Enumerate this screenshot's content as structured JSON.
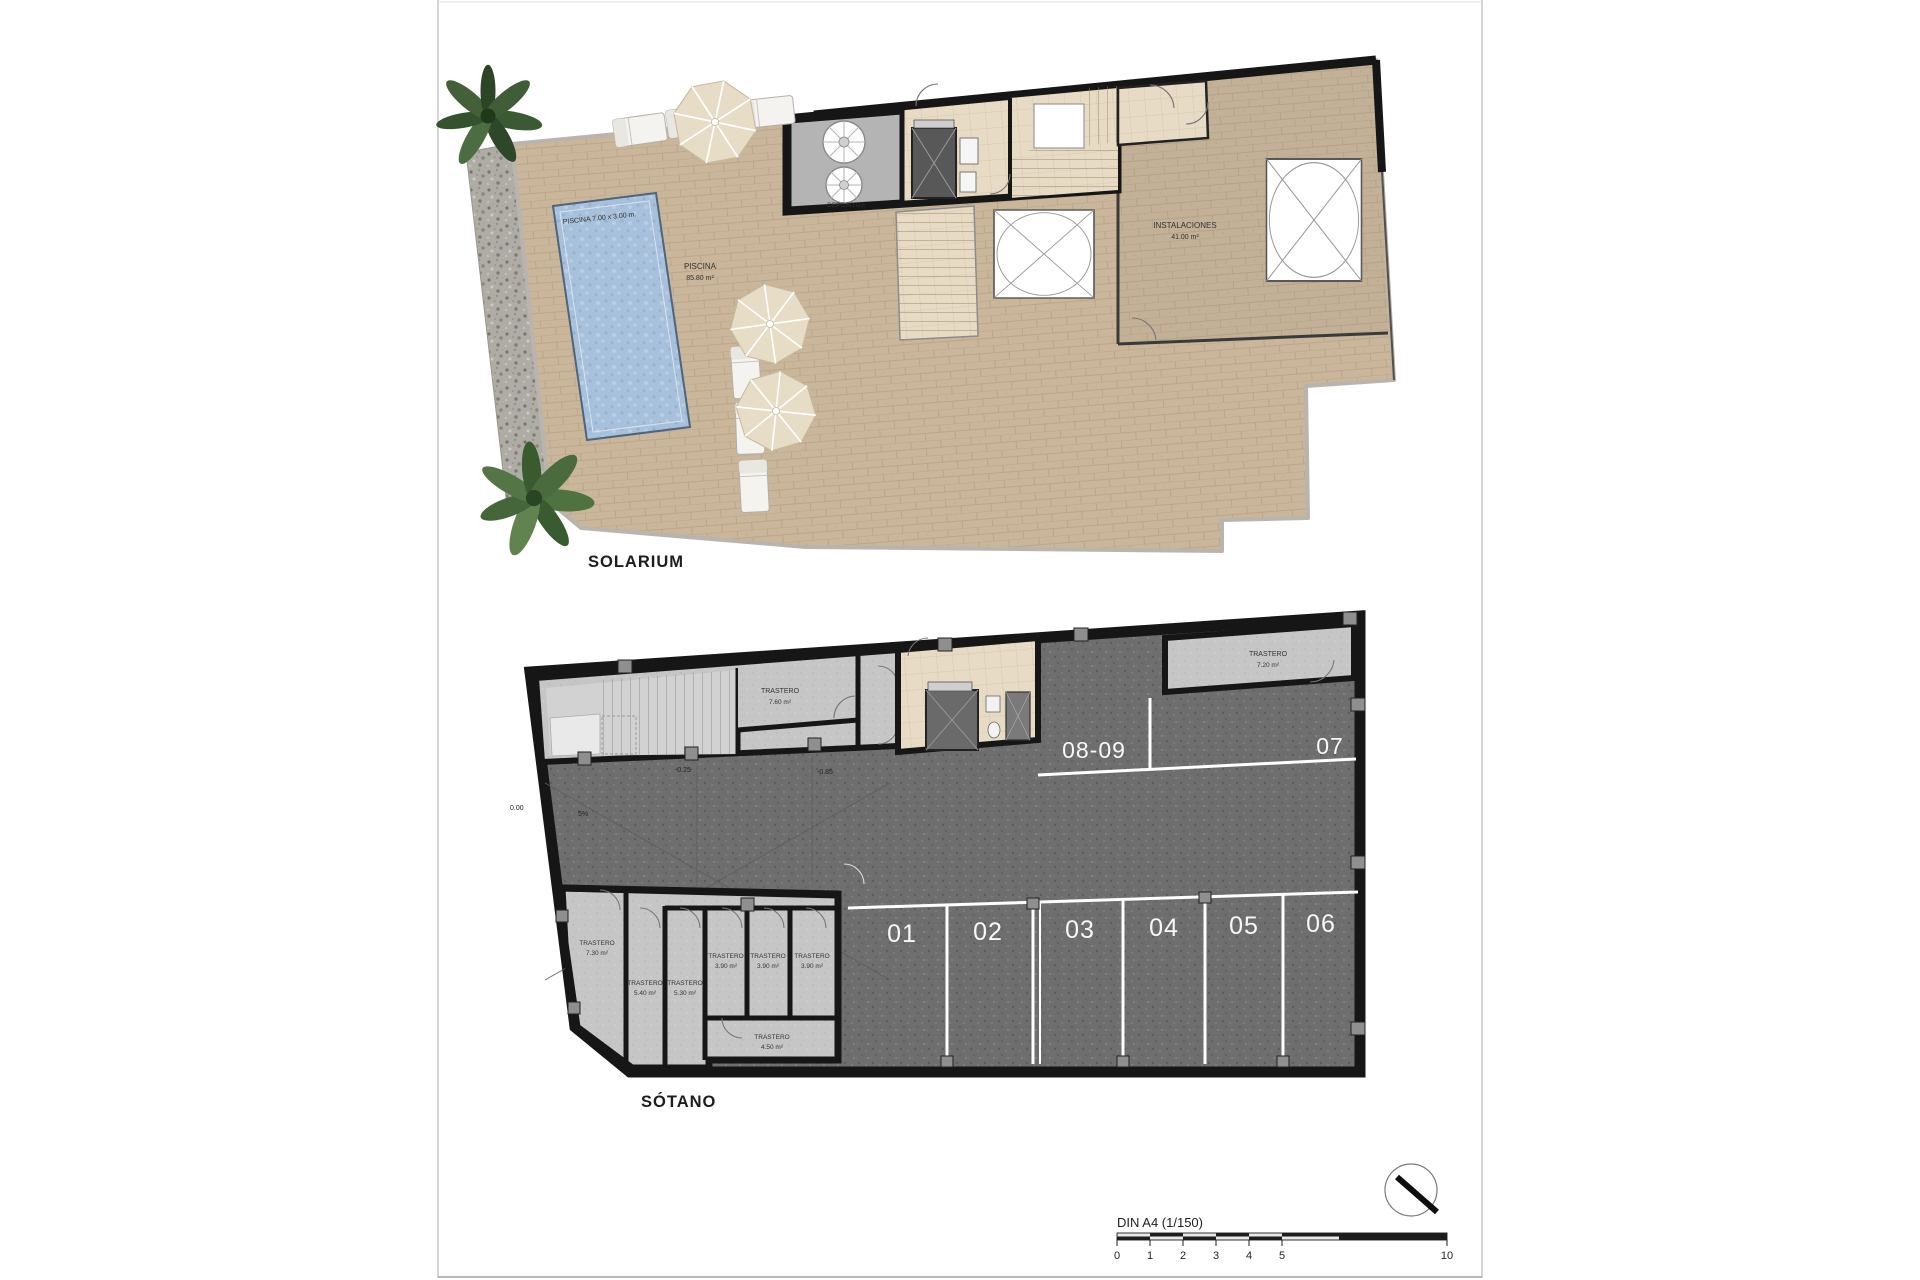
{
  "solarium": {
    "title": "SOLARIUM",
    "pool": {
      "dim_label": "PISCINA 7.00 x 3.00 m.",
      "area_name": "PISCINA",
      "area_value": "85.80 m²"
    },
    "rooms": {
      "depositos": "DEPOSITOS",
      "instalaciones_name": "INSTALACIONES",
      "instalaciones_area": "41.00 m²"
    }
  },
  "sotano": {
    "title": "SÓTANO",
    "storerooms": [
      {
        "name": "TRASTERO",
        "area": "7.60 m²"
      },
      {
        "name": "TRASTERO",
        "area": "7.20 m²"
      },
      {
        "name": "TRASTERO",
        "area": "7.30 m²"
      },
      {
        "name": "TRASTERO",
        "area": "5.40 m²"
      },
      {
        "name": "TRASTERO",
        "area": "5.30 m²"
      },
      {
        "name": "TRASTERO",
        "area": "3.90 m²"
      },
      {
        "name": "TRASTERO",
        "area": "3.90 m²"
      },
      {
        "name": "TRASTERO",
        "area": "3.90 m²"
      },
      {
        "name": "TRASTERO",
        "area": "4.50 m²"
      }
    ],
    "parking": {
      "double": "08-09",
      "seven": "07",
      "spots": [
        "01",
        "02",
        "03",
        "04",
        "05",
        "06"
      ]
    },
    "levels": {
      "zero": "0.00",
      "slope": "5%",
      "upper": "-0.25",
      "lower": "-0.85"
    }
  },
  "footer": {
    "scale_label": "DIN A4 (1/150)",
    "ticks": [
      "0",
      "1",
      "2",
      "3",
      "4",
      "5",
      "10"
    ]
  },
  "colors": {
    "terrace_tan": "#c9b69b",
    "instalaciones_tan": "#c2b097",
    "pool_blue": "#a7c0db",
    "floor_dark": "#6e6e6e",
    "room_light": "#c6c6c6",
    "core_beige": "#e7dbc5",
    "wall_black": "#161616",
    "parking_text": "#ffffff",
    "sheet_border": "#c9c9c9"
  }
}
